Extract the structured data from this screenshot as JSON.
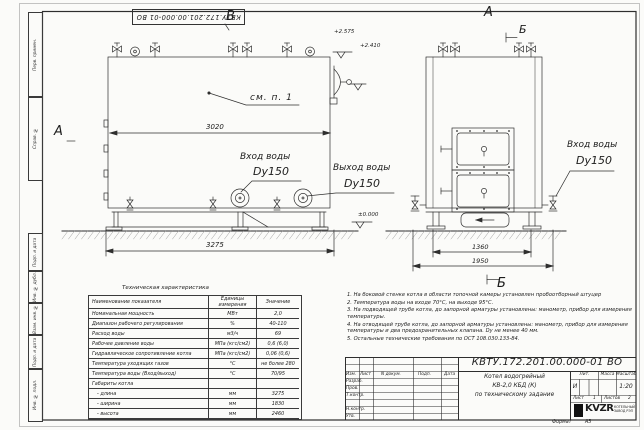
{
  "frame": {
    "stamp": "КВТУ.172.201.00.000-01 ВО",
    "side_labels": [
      "Перв. примен.",
      "Справ. №",
      "Подп. и дата",
      "Инв. № дубл.",
      "Взам. инв. №",
      "Подп. и дата",
      "Инв. № подл."
    ],
    "format_label": "Формат",
    "format_value": "А3"
  },
  "drawing": {
    "view_b": "В",
    "section_a_left": "А",
    "front_a": "А",
    "front_b_top": "Б",
    "front_b_bottom": "Б",
    "callout": "см. п. 1",
    "elev_top": "+2.575",
    "elev_mid": "+2.410",
    "elev_zero": "±0.000",
    "dim_3020": "3020",
    "dim_3275": "3275",
    "dim_1360": "1360",
    "dim_1950": "1950",
    "inlet_side_line1": "Вход воды",
    "inlet_side_line2": "Dy150",
    "outlet_side_line1": "Выход воды",
    "outlet_side_line2": "Dy150",
    "inlet_front_line1": "Вход воды",
    "inlet_front_line2": "Dy150"
  },
  "table": {
    "title": "Техническая характеристика",
    "headers": [
      "Наименование показателя",
      "Единицы измерения",
      "Значение"
    ],
    "rows": [
      [
        "Номинальная мощность",
        "МВт",
        "2,0"
      ],
      [
        "Диапазон рабочего регулирования",
        "%",
        "40-110"
      ],
      [
        "Расход воды",
        "м3/ч",
        "69"
      ],
      [
        "Рабочее давление воды",
        "МПа (кгс/см2)",
        "0,6 (6,0)"
      ],
      [
        "Гидравлическое сопротивление котла",
        "МПа (кгс/см2)",
        "0,06 (0,6)"
      ],
      [
        "Температура уходящих газов",
        "°С",
        "не более 280"
      ],
      [
        "Температура воды (Вход/выход)",
        "°С",
        "70/95"
      ],
      [
        "Габариты котла",
        "",
        ""
      ],
      [
        "- длина",
        "мм",
        "3275"
      ],
      [
        "- ширина",
        "мм",
        "1830"
      ],
      [
        "- высота",
        "мм",
        "2460"
      ]
    ]
  },
  "notes": [
    "1.  На боковой стенке котла в области топочной камеры установлен пробоотборный штуцер",
    "2.  Температура воды на входе 70°С, на выходе 95°С.",
    "3.  На подводящей трубе котла, до запорной арматуры установлены: манометр, прибор для измерения температуры.",
    "4.  На отводящей трубе котла, до запорной арматуры установлены: манометр, прибор для измерения температуры и два предохранительных клапана. Dу не менее 40 мм.",
    "5.  Остальные технические требования по ОСТ 108.030.133-84."
  ],
  "title_block": {
    "doc_number": "КВТУ.172.201.00.000-01 ВО",
    "name_line1": "Котел водогрейный",
    "name_line2": "КВ-2,0 КБД (К)",
    "name_line3": "по техническому задание",
    "col_izm": "Изм.",
    "col_list": "Лист",
    "col_ndoc": "N докум.",
    "col_podp": "Подп.",
    "col_data": "Дата",
    "row_razrab": "Разраб.",
    "row_prov": "Пров.",
    "row_tkontr": "Т.контр.",
    "row_nkontr": "Н.контр.",
    "row_utv": "Утв.",
    "lit_label": "Лит.",
    "mass_label": "Масса",
    "scale_label": "Масштаб",
    "lit_value": "И",
    "scale_value": "1:20",
    "sheet_label": "Лист",
    "sheet_value": "1",
    "sheets_label": "Листов",
    "sheets_value": "2",
    "logo_text": "KVZR",
    "logo_sub1": "КОТЕЛЬНЫЙ",
    "logo_sub2": "ЗАВОД РЭП"
  }
}
